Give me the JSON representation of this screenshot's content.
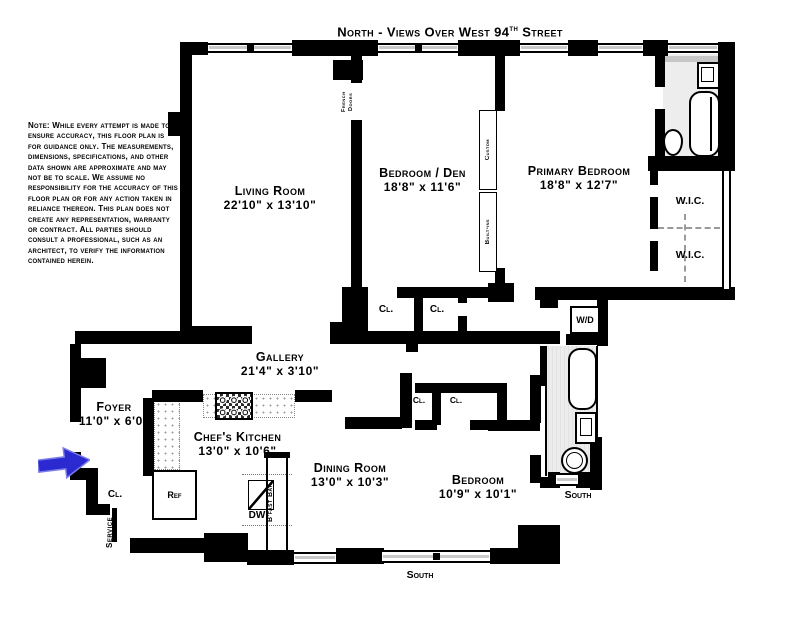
{
  "title": {
    "prefix": "North - Views Over West 94",
    "sup": "th",
    "suffix": " Street"
  },
  "note": "Note: While every attempt is made to ensure accuracy, this floor plan is for guidance only. The measurements, dimensions, specifications, and other data shown are approximate and may not be to scale. We assume no responsibility for the accuracy of this floor plan or for any action taken in reliance thereon. This plan does not create any representation, warranty or contract. All parties should consult a professional, such as an architect, to verify the information contained herein.",
  "rooms": {
    "living": {
      "name": "Living Room",
      "dims": "22'10\" x 13'10\""
    },
    "den": {
      "name": "Bedroom / Den",
      "dims": "18'8\" x 11'6\""
    },
    "primary": {
      "name": "Primary Bedroom",
      "dims": "18'8\" x 12'7\""
    },
    "gallery": {
      "name": "Gallery",
      "dims": "21'4\" x 3'10\""
    },
    "foyer": {
      "name": "Foyer",
      "dims": "11'0\" x 6'0\""
    },
    "kitchen": {
      "name": "Chef's Kitchen",
      "dims": "13'0\" x 10'6\""
    },
    "dining": {
      "name": "Dining Room",
      "dims": "13'0\" x 10'3\""
    },
    "bedroom2": {
      "name": "Bedroom",
      "dims": "10'9\" x 10'1\""
    }
  },
  "labels": {
    "wic": "W.I.C.",
    "cl": "Cl.",
    "wd": "W/D",
    "ref": "Ref",
    "dw": "DW",
    "bfast_bar": "B'fast Bar",
    "french_doors_line1": "French",
    "french_doors_line2": "Doors",
    "custom": "Custom",
    "built_ins": "Built-ins",
    "service": "Service",
    "south": "South"
  },
  "colors": {
    "wall": "#000000",
    "arrow": "#2a2ad0",
    "floor_tint": "#ededed",
    "window_bar": "#c9c9c9"
  }
}
